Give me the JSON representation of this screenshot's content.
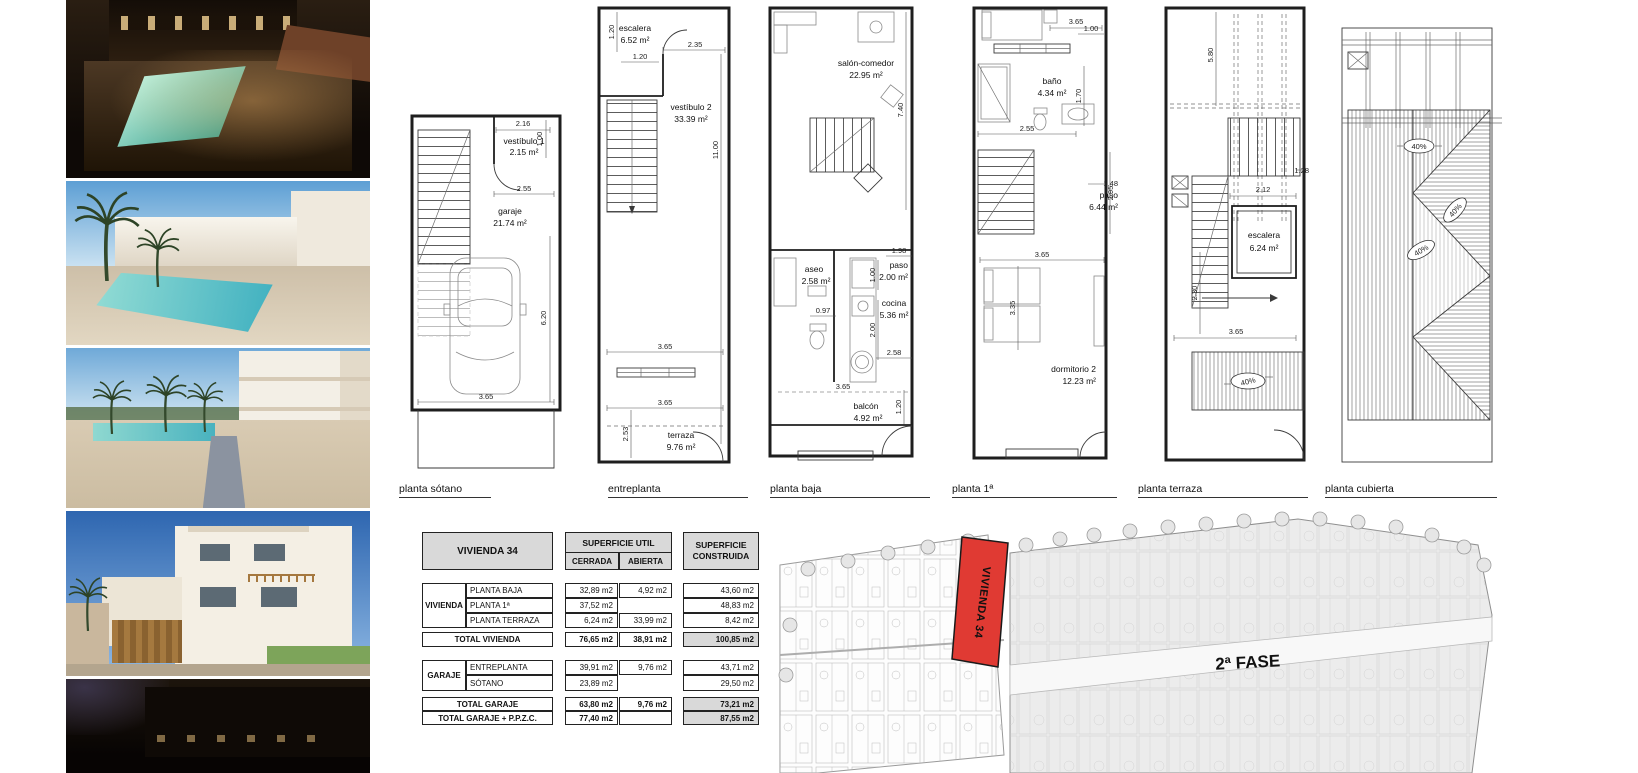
{
  "photos": [
    {
      "desc": "night aerial render of communal pool terrace"
    },
    {
      "desc": "daytime render of communal pool and townhouses"
    },
    {
      "desc": "render of pool walkway with palm trees"
    },
    {
      "desc": "street render of white townhouse"
    },
    {
      "desc": "dusk street render"
    }
  ],
  "plans": [
    {
      "label": "planta sótano",
      "rooms": [
        {
          "name": "vestíbulo 1",
          "area": "2.15 m²"
        },
        {
          "name": "garaje",
          "area": "21.74 m²"
        }
      ],
      "dims": [
        "2.16",
        "1.00",
        "2.55",
        "6.20",
        "3.65"
      ]
    },
    {
      "label": "entreplanta",
      "rooms": [
        {
          "name": "escalera",
          "area": "6.52 m²"
        },
        {
          "name": "vestíbulo 2",
          "area": "33.39 m²"
        },
        {
          "name": "terraza",
          "area": "9.76 m²"
        }
      ],
      "dims": [
        "1.20",
        "1.20",
        "2.35",
        "11.00",
        "3.65",
        "3.65",
        "2.53"
      ]
    },
    {
      "label": "planta baja",
      "rooms": [
        {
          "name": "salón-comedor",
          "area": "22.95 m²"
        },
        {
          "name": "aseo",
          "area": "2.58 m²"
        },
        {
          "name": "paso",
          "area": "2.00 m²"
        },
        {
          "name": "cocina",
          "area": "5.36 m²"
        },
        {
          "name": "balcón",
          "area": "4.92 m²"
        }
      ],
      "dims": [
        "7.40",
        "1.98",
        "1.00",
        "0.97",
        "2.00",
        "2.58",
        "3.65",
        "1.20"
      ]
    },
    {
      "label": "planta 1ª",
      "rooms": [
        {
          "name": "baño",
          "area": "4.34 m²"
        },
        {
          "name": "paso",
          "area": "6.44 m²"
        },
        {
          "name": "dormitorio 2",
          "area": "12.23 m²"
        }
      ],
      "dims": [
        "3.65",
        "1.00",
        "2.55",
        "1.70",
        "1.48",
        "2.95",
        "3.65",
        "3.35"
      ]
    },
    {
      "label": "planta terraza",
      "rooms": [
        {
          "name": "escalera",
          "area": "6.24 m²"
        }
      ],
      "dims": [
        "5.80",
        "2.12",
        "1.28",
        "2.30",
        "3.65",
        "40%"
      ]
    },
    {
      "label": "planta cubierta",
      "rooms": [],
      "dims": [
        "40%",
        "40%",
        "40%"
      ]
    }
  ],
  "table": {
    "title": "VIVIENDA 34",
    "util_header": "SUPERFICIE UTIL",
    "cerrada": "CERRADA",
    "abierta": "ABIERTA",
    "cons_header_1": "SUPERFICIE",
    "cons_header_2": "CONSTRUIDA",
    "vivienda_group": "VIVIENDA",
    "garaje_group": "GARAJE",
    "rows": {
      "planta_baja": {
        "label": "PLANTA BAJA",
        "cerrada": "32,89 m2",
        "abierta": "4,92 m2",
        "construida": "43,60 m2"
      },
      "planta_1": {
        "label": "PLANTA 1ª",
        "cerrada": "37,52 m2",
        "construida": "48,83 m2"
      },
      "planta_terraza": {
        "label": "PLANTA TERRAZA",
        "cerrada": "6,24 m2",
        "abierta": "33,99 m2",
        "construida": "8,42 m2"
      },
      "total_vivienda": {
        "label": "TOTAL VIVIENDA",
        "cerrada": "76,65 m2",
        "abierta": "38,91 m2",
        "construida": "100,85 m2"
      },
      "entreplanta": {
        "label": "ENTREPLANTA",
        "cerrada": "39,91 m2",
        "abierta": "9,76 m2",
        "construida": "43,71 m2"
      },
      "sotano": {
        "label": "SÓTANO",
        "cerrada": "23,89 m2",
        "construida": "29,50 m2"
      },
      "total_garaje": {
        "label": "TOTAL GARAJE",
        "cerrada": "63,80 m2",
        "abierta": "9,76 m2",
        "construida": "73,21 m2"
      },
      "total_garaje_ppzc": {
        "label": "TOTAL GARAJE + P.P.Z.C.",
        "cerrada": "77,40 m2",
        "construida": "87,55 m2"
      }
    }
  },
  "site_plan": {
    "highlight_label": "VIVIENDA 34",
    "phase_label": "2ª FASE",
    "highlight_color": "#e03a33"
  },
  "colors": {
    "highlight_red": "#e03a33",
    "table_gray": "#d9d9d9",
    "site_gray": "#ececec"
  }
}
